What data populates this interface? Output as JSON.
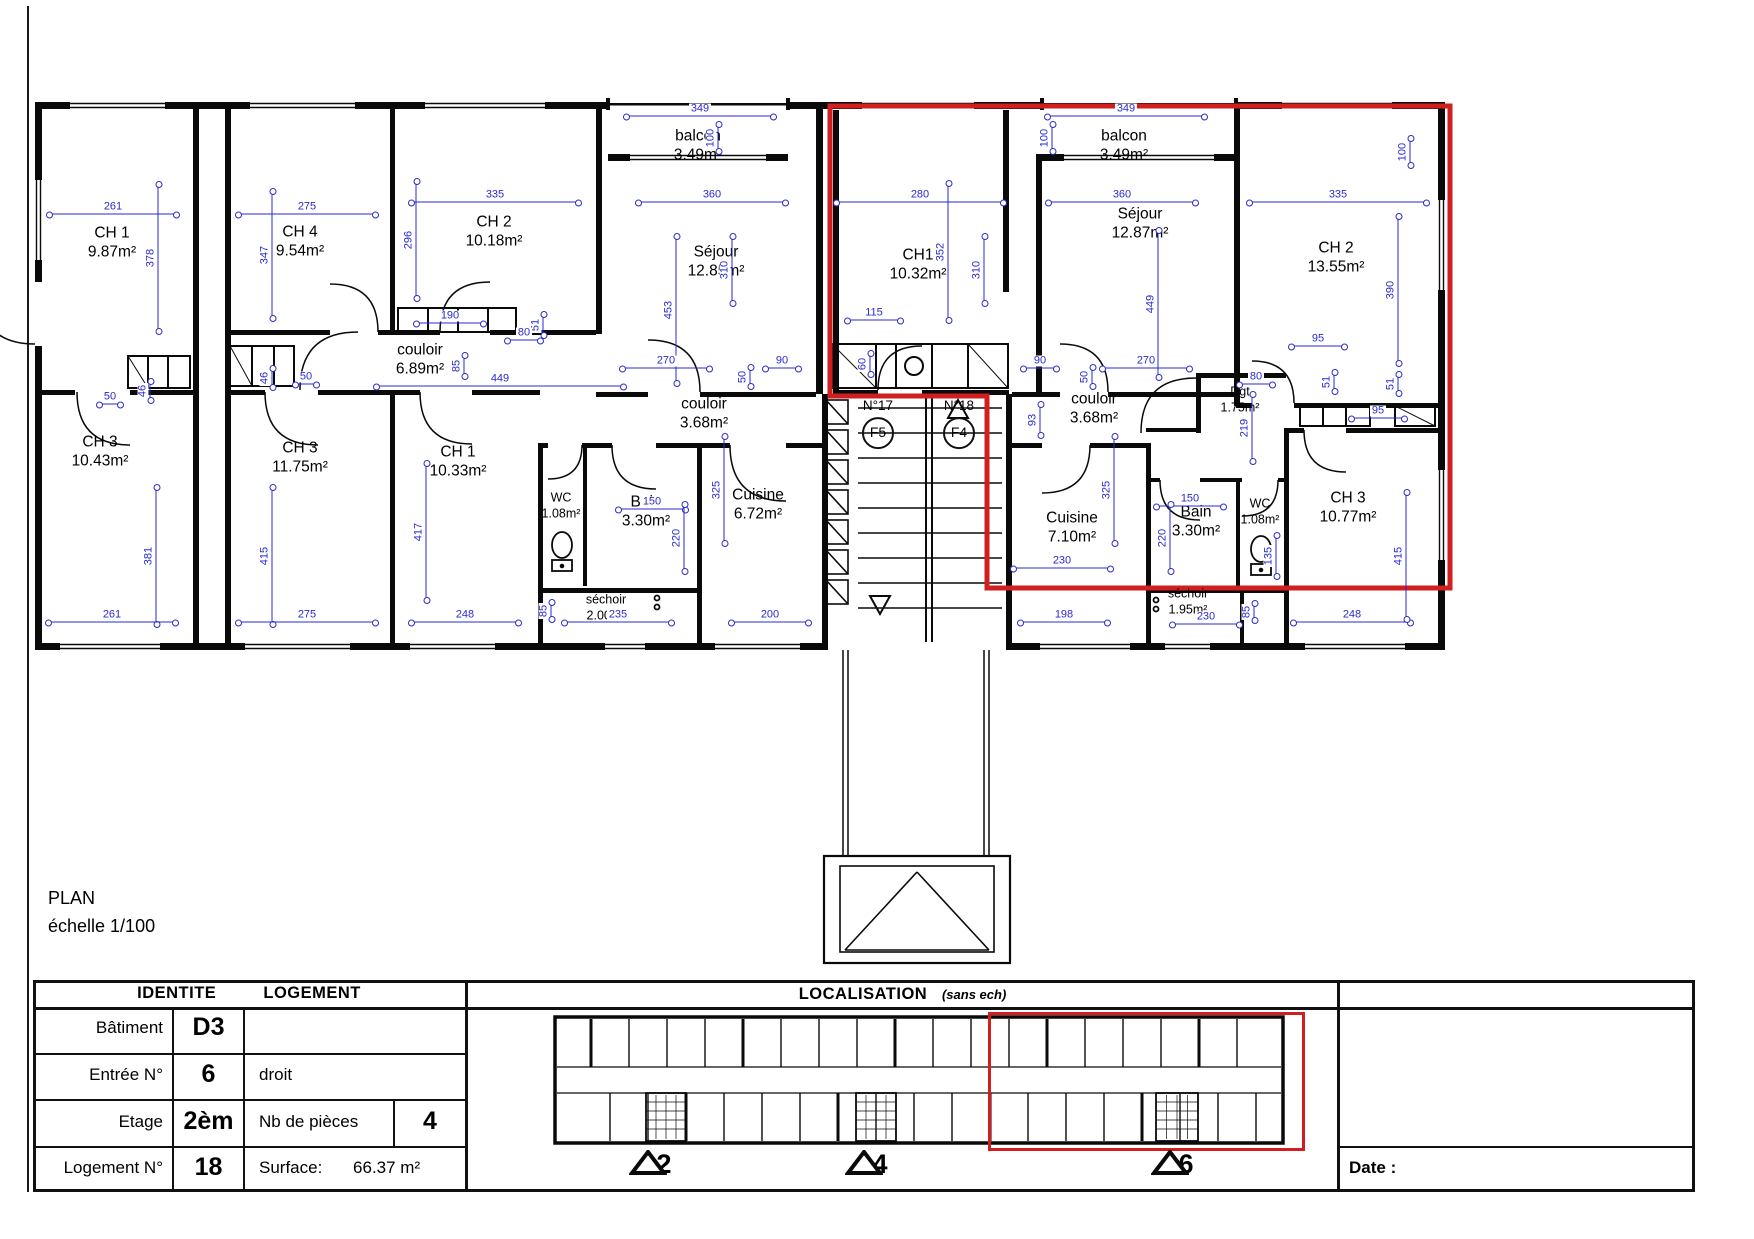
{
  "page": {
    "title": "PLAN",
    "scale": "échelle 1/100",
    "date_label": "Date :"
  },
  "colors": {
    "red": "#cf1f1f",
    "blue": "#2a2ad0",
    "wall": "#0a0a0a"
  },
  "plan": {
    "rooms": [
      {
        "n": "CH 1",
        "a": "9.87m²",
        "x": 112,
        "y": 243
      },
      {
        "n": "CH 4",
        "a": "9.54m²",
        "x": 300,
        "y": 242
      },
      {
        "n": "CH 2",
        "a": "10.18m²",
        "x": 494,
        "y": 232
      },
      {
        "n": "balcon",
        "a": "3.49m²",
        "x": 698,
        "y": 146
      },
      {
        "n": "Séjour",
        "a": "12.85m²",
        "x": 716,
        "y": 262
      },
      {
        "n": "couloir",
        "a": "6.89m²",
        "x": 420,
        "y": 360
      },
      {
        "n": "CH1",
        "a": "10.32m²",
        "x": 918,
        "y": 265
      },
      {
        "n": "balcon",
        "a": "3.49m²",
        "x": 1124,
        "y": 146
      },
      {
        "n": "Séjour",
        "a": "12.87m²",
        "x": 1140,
        "y": 224
      },
      {
        "n": "CH 2",
        "a": "13.55m²",
        "x": 1336,
        "y": 258
      },
      {
        "n": "couloir",
        "a": "3.68m²",
        "x": 704,
        "y": 414
      },
      {
        "n": "couloir",
        "a": "3.68m²",
        "x": 1094,
        "y": 409
      },
      {
        "n": "CH 3",
        "a": "10.43m²",
        "x": 100,
        "y": 452
      },
      {
        "n": "CH 3",
        "a": "11.75m²",
        "x": 300,
        "y": 458
      },
      {
        "n": "CH 1",
        "a": "10.33m²",
        "x": 458,
        "y": 462
      },
      {
        "n": "WC",
        "a": "1.08m²",
        "x": 561,
        "y": 506,
        "s": 1
      },
      {
        "n": "Bain",
        "a": "3.30m²",
        "x": 646,
        "y": 512
      },
      {
        "n": "Cuisine",
        "a": "6.72m²",
        "x": 758,
        "y": 505
      },
      {
        "n": "séchoir",
        "a": "2.00m²",
        "x": 606,
        "y": 608,
        "s": 1
      },
      {
        "n": "Cuisine",
        "a": "7.10m²",
        "x": 1072,
        "y": 528
      },
      {
        "n": "Bain",
        "a": "3.30m²",
        "x": 1196,
        "y": 522
      },
      {
        "n": "WC",
        "a": "1.08m²",
        "x": 1260,
        "y": 512,
        "s": 1
      },
      {
        "n": "séchoir",
        "a": "1.95m²",
        "x": 1188,
        "y": 602,
        "s": 1
      },
      {
        "n": "Dgt",
        "a": "1.75m²",
        "x": 1240,
        "y": 400,
        "s": 1
      },
      {
        "n": "CH 3",
        "a": "10.77m²",
        "x": 1348,
        "y": 508
      }
    ],
    "units": [
      {
        "no": "N°17",
        "f": "F5",
        "x": 878,
        "y": 424
      },
      {
        "no": "N°18",
        "f": "F4",
        "x": 959,
        "y": 424
      }
    ],
    "dims": [
      {
        "t": "261",
        "x": 113,
        "y": 208,
        "o": "h",
        "l": 130
      },
      {
        "t": "378",
        "x": 152,
        "y": 258,
        "o": "v",
        "l": 150
      },
      {
        "t": "275",
        "x": 307,
        "y": 208,
        "o": "h",
        "l": 140
      },
      {
        "t": "347",
        "x": 266,
        "y": 255,
        "o": "v",
        "l": 130
      },
      {
        "t": "335",
        "x": 495,
        "y": 196,
        "o": "h",
        "l": 170
      },
      {
        "t": "296",
        "x": 410,
        "y": 240,
        "o": "v",
        "l": 120
      },
      {
        "t": "349",
        "x": 700,
        "y": 110,
        "o": "h",
        "l": 150
      },
      {
        "t": "100",
        "x": 712,
        "y": 138,
        "o": "v",
        "l": 30
      },
      {
        "t": "360",
        "x": 712,
        "y": 196,
        "o": "h",
        "l": 150
      },
      {
        "t": "453",
        "x": 670,
        "y": 310,
        "o": "v",
        "l": 150
      },
      {
        "t": "280",
        "x": 920,
        "y": 196,
        "o": "h",
        "l": 170
      },
      {
        "t": "352",
        "x": 942,
        "y": 252,
        "o": "v",
        "l": 140
      },
      {
        "t": "310",
        "x": 726,
        "y": 270,
        "o": "v",
        "l": 70
      },
      {
        "t": "310",
        "x": 978,
        "y": 270,
        "o": "v",
        "l": 70
      },
      {
        "t": "349",
        "x": 1126,
        "y": 110,
        "o": "h",
        "l": 160
      },
      {
        "t": "100",
        "x": 1046,
        "y": 138,
        "o": "v",
        "l": 30
      },
      {
        "t": "360",
        "x": 1122,
        "y": 196,
        "o": "h",
        "l": 150
      },
      {
        "t": "449",
        "x": 1152,
        "y": 304,
        "o": "v",
        "l": 150
      },
      {
        "t": "335",
        "x": 1338,
        "y": 196,
        "o": "h",
        "l": 180
      },
      {
        "t": "390",
        "x": 1392,
        "y": 290,
        "o": "v",
        "l": 150
      },
      {
        "t": "100",
        "x": 1404,
        "y": 152,
        "o": "v",
        "l": 30
      },
      {
        "t": "270",
        "x": 666,
        "y": 362,
        "o": "h",
        "l": 90
      },
      {
        "t": "90",
        "x": 782,
        "y": 362,
        "o": "h",
        "l": 36
      },
      {
        "t": "90",
        "x": 1040,
        "y": 362,
        "o": "h",
        "l": 36
      },
      {
        "t": "270",
        "x": 1146,
        "y": 362,
        "o": "h",
        "l": 90
      },
      {
        "t": "115",
        "x": 874,
        "y": 314,
        "o": "h",
        "l": 56
      },
      {
        "t": "190",
        "x": 450,
        "y": 317,
        "o": "h",
        "l": 70
      },
      {
        "t": "51",
        "x": 537,
        "y": 325,
        "o": "v",
        "l": 24
      },
      {
        "t": "80",
        "x": 524,
        "y": 334,
        "o": "h",
        "l": 36
      },
      {
        "t": "50",
        "x": 744,
        "y": 377,
        "o": "v",
        "l": 22
      },
      {
        "t": "50",
        "x": 1086,
        "y": 377,
        "o": "v",
        "l": 22
      },
      {
        "t": "93",
        "x": 1034,
        "y": 420,
        "o": "v",
        "l": 34
      },
      {
        "t": "449",
        "x": 500,
        "y": 380,
        "o": "h",
        "l": 250
      },
      {
        "t": "85",
        "x": 458,
        "y": 366,
        "o": "v",
        "l": 24
      },
      {
        "t": "50",
        "x": 110,
        "y": 398,
        "o": "h",
        "l": 24
      },
      {
        "t": "46",
        "x": 144,
        "y": 391,
        "o": "v",
        "l": 22
      },
      {
        "t": "50",
        "x": 306,
        "y": 378,
        "o": "h",
        "l": 24
      },
      {
        "t": "46",
        "x": 266,
        "y": 378,
        "o": "v",
        "l": 22
      },
      {
        "t": "60",
        "x": 864,
        "y": 364,
        "o": "v",
        "l": 24
      },
      {
        "t": "325",
        "x": 718,
        "y": 490,
        "o": "v",
        "l": 110
      },
      {
        "t": "325",
        "x": 1108,
        "y": 490,
        "o": "v",
        "l": 110
      },
      {
        "t": "150",
        "x": 652,
        "y": 503,
        "o": "h",
        "l": 70
      },
      {
        "t": "220",
        "x": 678,
        "y": 538,
        "o": "v",
        "l": 70
      },
      {
        "t": "150",
        "x": 1190,
        "y": 500,
        "o": "h",
        "l": 70
      },
      {
        "t": "220",
        "x": 1164,
        "y": 538,
        "o": "v",
        "l": 70
      },
      {
        "t": "230",
        "x": 1062,
        "y": 562,
        "o": "h",
        "l": 100
      },
      {
        "t": "135",
        "x": 1270,
        "y": 556,
        "o": "v",
        "l": 44
      },
      {
        "t": "219",
        "x": 1246,
        "y": 428,
        "o": "v",
        "l": 70
      },
      {
        "t": "80",
        "x": 1256,
        "y": 378,
        "o": "h",
        "l": 36
      },
      {
        "t": "95",
        "x": 1318,
        "y": 340,
        "o": "h",
        "l": 56
      },
      {
        "t": "51",
        "x": 1328,
        "y": 382,
        "o": "v",
        "l": 22
      },
      {
        "t": "95",
        "x": 1378,
        "y": 412,
        "o": "h",
        "l": 56
      },
      {
        "t": "51",
        "x": 1392,
        "y": 384,
        "o": "v",
        "l": 22
      },
      {
        "t": "381",
        "x": 150,
        "y": 556,
        "o": "v",
        "l": 140
      },
      {
        "t": "261",
        "x": 112,
        "y": 616,
        "o": "h",
        "l": 130
      },
      {
        "t": "415",
        "x": 266,
        "y": 556,
        "o": "v",
        "l": 140
      },
      {
        "t": "275",
        "x": 307,
        "y": 616,
        "o": "h",
        "l": 140
      },
      {
        "t": "417",
        "x": 420,
        "y": 532,
        "o": "v",
        "l": 140
      },
      {
        "t": "248",
        "x": 465,
        "y": 616,
        "o": "h",
        "l": 110
      },
      {
        "t": "235",
        "x": 618,
        "y": 616,
        "o": "h",
        "l": 110
      },
      {
        "t": "200",
        "x": 770,
        "y": 616,
        "o": "h",
        "l": 80
      },
      {
        "t": "85",
        "x": 545,
        "y": 611,
        "o": "v",
        "l": 20
      },
      {
        "t": "198",
        "x": 1064,
        "y": 616,
        "o": "h",
        "l": 90
      },
      {
        "t": "230",
        "x": 1206,
        "y": 618,
        "o": "h",
        "l": 70
      },
      {
        "t": "85",
        "x": 1248,
        "y": 612,
        "o": "v",
        "l": 20
      },
      {
        "t": "248",
        "x": 1352,
        "y": 616,
        "o": "h",
        "l": 120
      },
      {
        "t": "415",
        "x": 1400,
        "y": 556,
        "o": "v",
        "l": 130
      }
    ]
  },
  "table": {
    "id_header_1": "IDENTITE",
    "id_header_2": "LOGEMENT",
    "loc_header": "LOCALISATION",
    "loc_note": "(sans ech)",
    "rows": {
      "batiment_label": "Bâtiment",
      "batiment_value": "D3",
      "entree_label": "Entrée N°",
      "entree_value": "6",
      "entree_extra": "droit",
      "etage_label": "Etage",
      "etage_value": "2èm",
      "pieces_label": "Nb de pièces",
      "pieces_value": "4",
      "logement_label": "Logement N°",
      "logement_value": "18",
      "surface_label": "Surface:",
      "surface_value": "66.37 m²"
    }
  },
  "localisation": {
    "markers": [
      {
        "t": "2",
        "x": 664
      },
      {
        "t": "4",
        "x": 880
      },
      {
        "t": "6",
        "x": 1186
      }
    ]
  }
}
